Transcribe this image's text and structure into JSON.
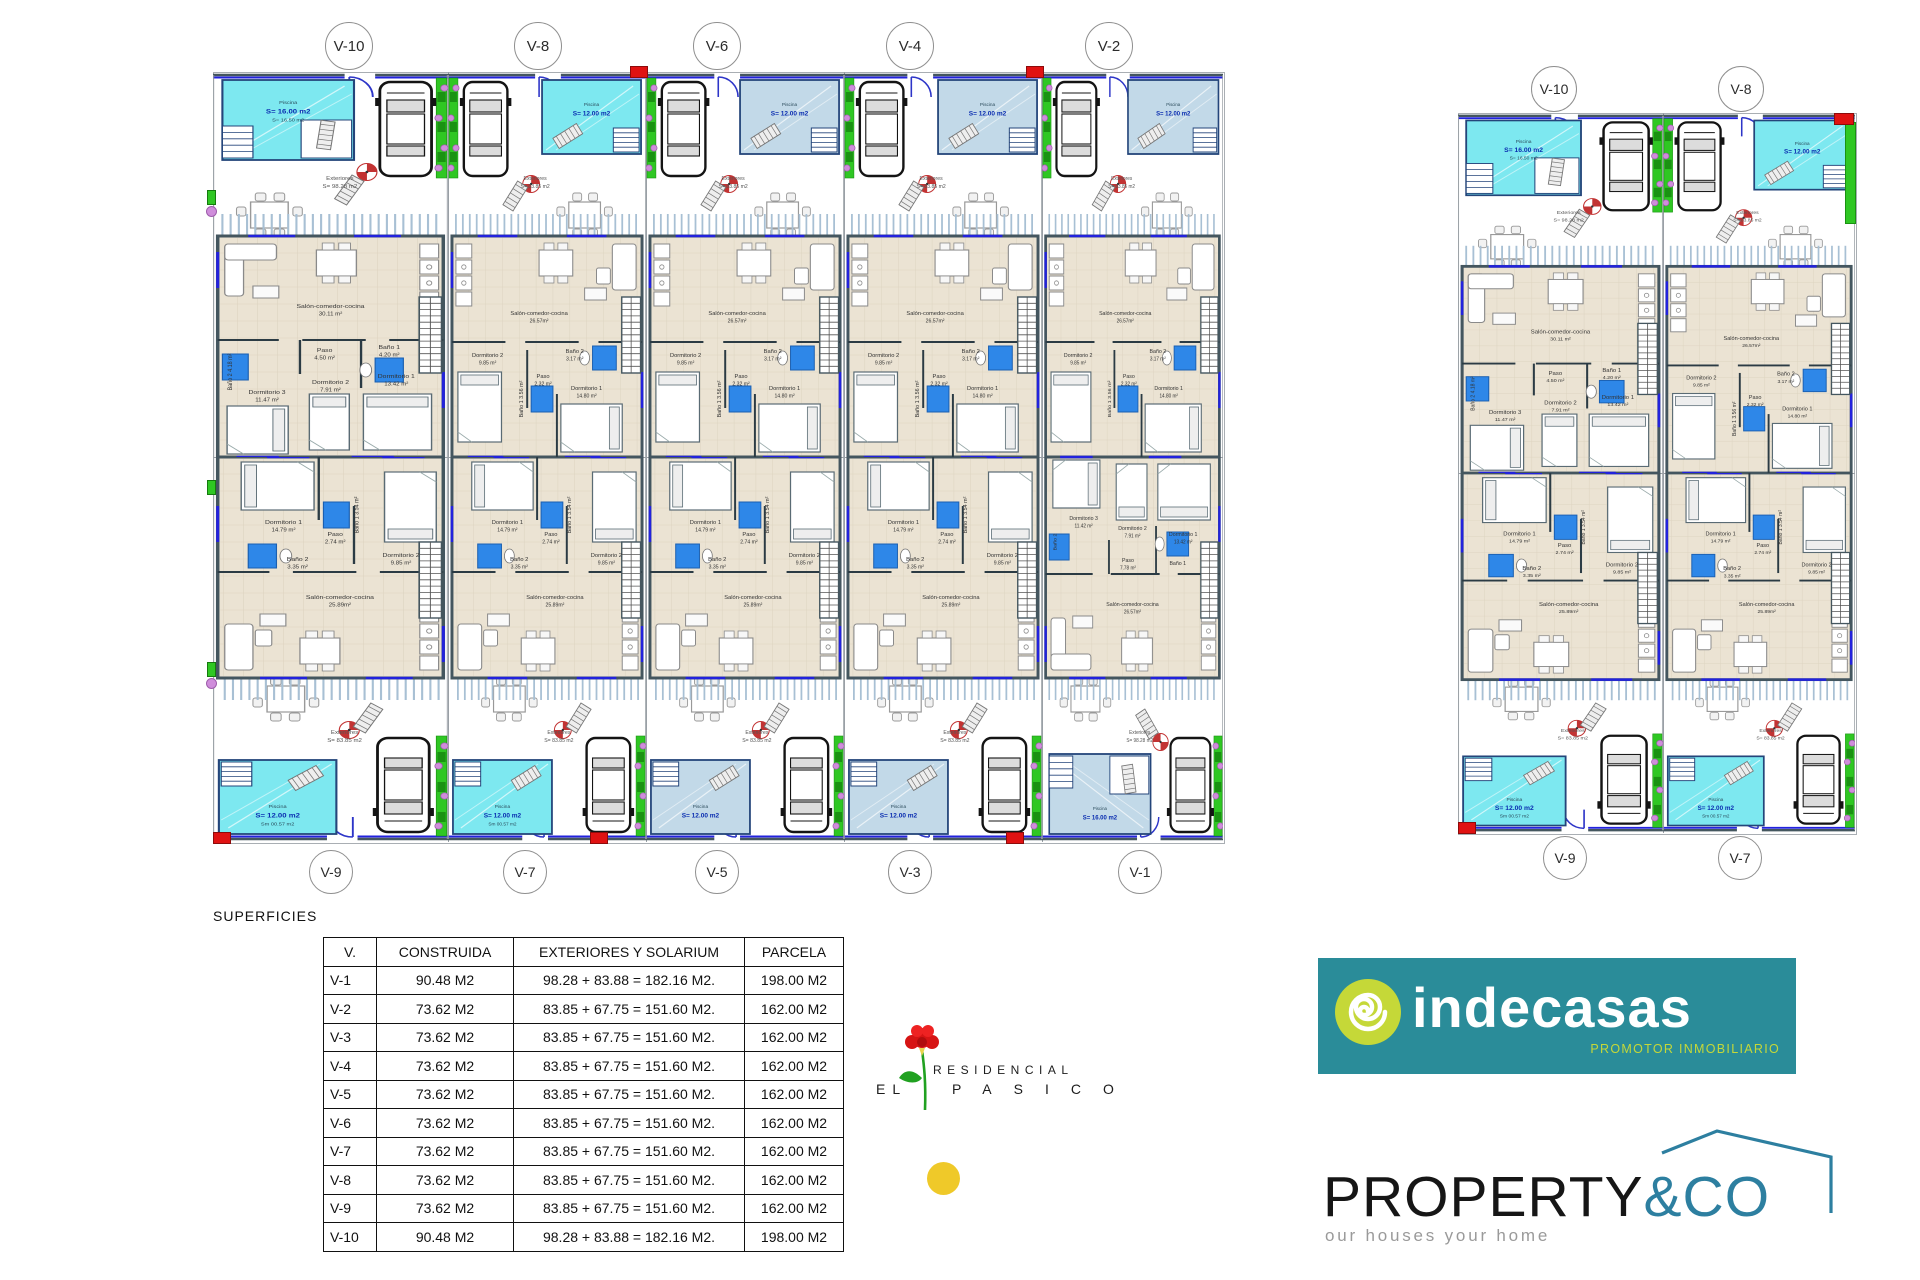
{
  "superficies": {
    "heading": "SUPERFICIES",
    "table": {
      "headers": [
        "V.",
        "CONSTRUIDA",
        "EXTERIORES Y SOLARIUM",
        "PARCELA"
      ],
      "rows": [
        [
          "V-1",
          "90.48 M2",
          "98.28 + 83.88 = 182.16 M2.",
          "198.00 M2"
        ],
        [
          "V-2",
          "73.62 M2",
          "83.85 + 67.75 = 151.60 M2.",
          "162.00 M2"
        ],
        [
          "V-3",
          "73.62 M2",
          "83.85 + 67.75 = 151.60 M2.",
          "162.00 M2"
        ],
        [
          "V-4",
          "73.62 M2",
          "83.85 + 67.75 = 151.60 M2.",
          "162.00 M2"
        ],
        [
          "V-5",
          "73.62 M2",
          "83.85 + 67.75 = 151.60 M2.",
          "162.00 M2"
        ],
        [
          "V-6",
          "73.62 M2",
          "83.85 + 67.75 = 151.60 M2.",
          "162.00 M2"
        ],
        [
          "V-7",
          "73.62 M2",
          "83.85 + 67.75 = 151.60 M2.",
          "162.00 M2"
        ],
        [
          "V-8",
          "73.62 M2",
          "83.85 + 67.75 = 151.60 M2.",
          "162.00 M2"
        ],
        [
          "V-9",
          "73.62 M2",
          "83.85 + 67.75 = 151.60 M2.",
          "162.00 M2"
        ],
        [
          "V-10",
          "90.48 M2",
          "98.28 + 83.88 = 182.16 M2.",
          "198.00 M2"
        ]
      ]
    }
  },
  "branding": {
    "residencial": {
      "line1": "RESIDENCIAL",
      "line2a": "EL",
      "line2b": "PASICO"
    },
    "indecasas": {
      "name": "indecasas",
      "tagline": "PROMOTOR INMOBILIARIO"
    },
    "property": {
      "name": "PROPERTY",
      "suffix": "&CO",
      "tagline": "our houses your home"
    }
  },
  "colors": {
    "pool_cyan": "#7de8f0",
    "pool_pale": "#c2d9e8",
    "pool_stroke": "#24457a",
    "hedge": "#2fc723",
    "hedge_dark": "#1a9212",
    "flower": "#cf8ddb",
    "wall": "#44565f",
    "floor": "#ebe3d3",
    "window_blue": "#2222dd",
    "door_blue": "#2d35c8",
    "fixture_blue": "#2e87e8",
    "marker_red": "#e01212",
    "indecasas_teal": "#2a8c99",
    "indecasas_lime": "#c5d838",
    "property_accent": "#2d7fa0",
    "yellow_dot": "#efc929",
    "carnation_red": "#d61414",
    "stem_green": "#21a121"
  },
  "plan_groups": [
    {
      "id": "left",
      "units": [
        {
          "id": "V-10",
          "row": "top",
          "variant": "corner",
          "pool": {
            "name": "Piscina",
            "area": "S= 16.00 m2",
            "sub": "S= 16.50 m2",
            "color": "cyan"
          },
          "exteriores": {
            "name": "Exteriores",
            "area": "S= 98.28 m2"
          },
          "rooms": {
            "salon": {
              "name": "Salón-comedor-cocina",
              "area": "30.11 m²"
            },
            "paso": {
              "name": "Paso",
              "area": "4.50 m²"
            },
            "bano1": {
              "name": "Baño 1",
              "area": "4.20 m²"
            },
            "bano2": {
              "name": "Baño 2",
              "area": "4.18 m²"
            },
            "dorm1": {
              "name": "Dormitorio 1",
              "area": "13.42 m²"
            },
            "dorm2": {
              "name": "Dormitorio 2",
              "area": "7.91 m²"
            },
            "dorm3": {
              "name": "Dormitorio 3",
              "area": "11.47 m²"
            }
          }
        },
        {
          "id": "V-8",
          "row": "top",
          "variant": "standard",
          "pool": {
            "name": "Piscina",
            "area": "S= 12.00 m2",
            "sub": "",
            "color": "cyan"
          },
          "exteriores": {
            "name": "Exteriores",
            "area": "S= 83.85 m2"
          },
          "rooms": {
            "salon": {
              "name": "Salón-comedor-cocina",
              "area": "26.57m²"
            },
            "paso": {
              "name": "Paso",
              "area": "2.32 m²"
            },
            "bano1": {
              "name": "Baño 1",
              "area": "3.56 m²"
            },
            "bano2": {
              "name": "Baño 2",
              "area": "3.17 m²"
            },
            "dorm1": {
              "name": "Dormitorio 1",
              "area": "14.80 m²"
            },
            "dorm2": {
              "name": "Dormitorio 2",
              "area": "9.85 m²"
            }
          }
        },
        {
          "id": "V-6",
          "row": "top",
          "variant": "standard",
          "pool": {
            "name": "Piscina",
            "area": "S= 12.00 m2",
            "sub": "",
            "color": "pale"
          },
          "exteriores": {
            "name": "Exteriores",
            "area": "S= 83.85 m2"
          },
          "rooms": {
            "salon": {
              "name": "Salón-comedor-cocina",
              "area": "26.57m²"
            },
            "paso": {
              "name": "Paso",
              "area": "2.32 m²"
            },
            "bano1": {
              "name": "Baño 1",
              "area": "3.56 m²"
            },
            "bano2": {
              "name": "Baño 2",
              "area": "3.17 m²"
            },
            "dorm1": {
              "name": "Dormitorio 1",
              "area": "14.80 m²"
            },
            "dorm2": {
              "name": "Dormitorio 2",
              "area": "9.85 m²"
            }
          }
        },
        {
          "id": "V-4",
          "row": "top",
          "variant": "standard",
          "pool": {
            "name": "Piscina",
            "area": "S= 12.00 m2",
            "sub": "",
            "color": "pale"
          },
          "exteriores": {
            "name": "Exteriores",
            "area": "S= 83.85 m2"
          },
          "rooms": {
            "salon": {
              "name": "Salón-comedor-cocina",
              "area": "26.57m²"
            },
            "paso": {
              "name": "Paso",
              "area": "2.32 m²"
            },
            "bano1": {
              "name": "Baño 1",
              "area": "3.56 m²"
            },
            "bano2": {
              "name": "Baño 2",
              "area": "3.17 m²"
            },
            "dorm1": {
              "name": "Dormitorio 1",
              "area": "14.80 m²"
            },
            "dorm2": {
              "name": "Dormitorio 2",
              "area": "9.85 m²"
            }
          }
        },
        {
          "id": "V-2",
          "row": "top",
          "variant": "standard",
          "pool": {
            "name": "Piscina",
            "area": "S= 12.00 m2",
            "sub": "",
            "color": "pale"
          },
          "exteriores": {
            "name": "Exteriores",
            "area": "S= 83.85 m2"
          },
          "rooms": {
            "salon": {
              "name": "Salón-comedor-cocina",
              "area": "26.57m²"
            },
            "paso": {
              "name": "Paso",
              "area": "2.32 m²"
            },
            "bano1": {
              "name": "Baño 1",
              "area": "3.56 m²"
            },
            "bano2": {
              "name": "Baño 2",
              "area": "3.17 m²"
            },
            "dorm1": {
              "name": "Dormitorio 1",
              "area": "14.80 m²"
            },
            "dorm2": {
              "name": "Dormitorio 2",
              "area": "9.85 m²"
            }
          }
        },
        {
          "id": "V-9",
          "row": "bottom",
          "variant": "standard",
          "pool": {
            "name": "Piscina",
            "area": "S= 12.00 m2",
            "sub": "Sm 00.57 m2",
            "color": "cyan"
          },
          "exteriores": {
            "name": "Exteriores",
            "area": "S= 83.85 m2"
          },
          "rooms": {
            "salon": {
              "name": "Salón-comedor-cocina",
              "area": "25.89m²"
            },
            "paso": {
              "name": "Paso",
              "area": "2.74 m²"
            },
            "bano1": {
              "name": "Baño 1",
              "area": "3.54 m²"
            },
            "bano2": {
              "name": "Baño 2",
              "area": "3.35 m²"
            },
            "dorm1": {
              "name": "Dormitorio 1",
              "area": "14.79 m²"
            },
            "dorm2": {
              "name": "Dormitorio 2",
              "area": "9.85 m²"
            }
          }
        },
        {
          "id": "V-7",
          "row": "bottom",
          "variant": "standard",
          "pool": {
            "name": "Piscina",
            "area": "S= 12.00 m2",
            "sub": "Sm 00.57 m2",
            "color": "cyan"
          },
          "exteriores": {
            "name": "Exteriores",
            "area": "S= 83.85 m2"
          },
          "rooms": {
            "salon": {
              "name": "Salón-comedor-cocina",
              "area": "25.89m²"
            },
            "paso": {
              "name": "Paso",
              "area": "2.74 m²"
            },
            "bano1": {
              "name": "Baño 1",
              "area": "3.54 m²"
            },
            "bano2": {
              "name": "Baño 2",
              "area": "3.35 m²"
            },
            "dorm1": {
              "name": "Dormitorio 1",
              "area": "14.79 m²"
            },
            "dorm2": {
              "name": "Dormitorio 2",
              "area": "9.85 m²"
            }
          }
        },
        {
          "id": "V-5",
          "row": "bottom",
          "variant": "standard",
          "pool": {
            "name": "Piscina",
            "area": "S= 12.00 m2",
            "sub": "",
            "color": "pale"
          },
          "exteriores": {
            "name": "Exteriores",
            "area": "S= 83.85 m2"
          },
          "rooms": {
            "salon": {
              "name": "Salón-comedor-cocina",
              "area": "25.89m²"
            },
            "paso": {
              "name": "Paso",
              "area": "2.74 m²"
            },
            "bano1": {
              "name": "Baño 1",
              "area": "3.54 m²"
            },
            "bano2": {
              "name": "Baño 2",
              "area": "3.35 m²"
            },
            "dorm1": {
              "name": "Dormitorio 1",
              "area": "14.79 m²"
            },
            "dorm2": {
              "name": "Dormitorio 2",
              "area": "9.85 m²"
            }
          }
        },
        {
          "id": "V-3",
          "row": "bottom",
          "variant": "standard",
          "pool": {
            "name": "Piscina",
            "area": "S= 12.00 m2",
            "sub": "",
            "color": "pale"
          },
          "exteriores": {
            "name": "Exteriores",
            "area": "S= 83.85 m2"
          },
          "rooms": {
            "salon": {
              "name": "Salón-comedor-cocina",
              "area": "25.89m²"
            },
            "paso": {
              "name": "Paso",
              "area": "2.74 m²"
            },
            "bano1": {
              "name": "Baño 1",
              "area": "3.54 m²"
            },
            "bano2": {
              "name": "Baño 2",
              "area": "3.35 m²"
            },
            "dorm1": {
              "name": "Dormitorio 1",
              "area": "14.79 m²"
            },
            "dorm2": {
              "name": "Dormitorio 2",
              "area": "9.85 m²"
            }
          }
        },
        {
          "id": "V-1",
          "row": "bottom",
          "variant": "corner",
          "pool": {
            "name": "Piscina",
            "area": "S= 16.00 m2",
            "sub": "",
            "color": "pale"
          },
          "exteriores": {
            "name": "Exteriores",
            "area": "S= 98.28 m2"
          },
          "rooms": {
            "salon": {
              "name": "Salón-comedor-cocina",
              "area": "26.57m²"
            },
            "paso": {
              "name": "Paso",
              "area": "7.78 m²"
            },
            "bano1": {
              "name": "Baño 1",
              "area": ""
            },
            "bano2": {
              "name": "Baño 2",
              "area": ""
            },
            "dorm1": {
              "name": "Dormitorio 1",
              "area": "13.42 m²"
            },
            "dorm2": {
              "name": "Dormitorio 2",
              "area": "7.91 m²"
            },
            "dorm3": {
              "name": "Dormitorio 3",
              "area": "11.42 m²"
            }
          }
        }
      ]
    },
    {
      "id": "right",
      "units": [
        {
          "id": "V-10",
          "row": "top",
          "variant": "corner",
          "pool": {
            "name": "Piscina",
            "area": "S= 16.00 m2",
            "sub": "S= 16.50 m2",
            "color": "cyan"
          },
          "exteriores": {
            "name": "Exteriores",
            "area": "S= 98.28 m2"
          },
          "rooms": {
            "salon": {
              "name": "Salón-comedor-cocina",
              "area": "30.11 m²"
            },
            "paso": {
              "name": "Paso",
              "area": "4.50 m²"
            },
            "bano1": {
              "name": "Baño 1",
              "area": "4.20 m²"
            },
            "bano2": {
              "name": "Baño 2",
              "area": "4.18 m²"
            },
            "dorm1": {
              "name": "Dormitorio 1",
              "area": "13.42 m²"
            },
            "dorm2": {
              "name": "Dormitorio 2",
              "area": "7.91 m²"
            },
            "dorm3": {
              "name": "Dormitorio 3",
              "area": "11.47 m²"
            }
          }
        },
        {
          "id": "V-8",
          "row": "top",
          "variant": "standard",
          "pool": {
            "name": "Piscina",
            "area": "S= 12.00 m2",
            "sub": "",
            "color": "cyan"
          },
          "exteriores": {
            "name": "Exteriores",
            "area": "S= 83.85 m2"
          },
          "rooms": {
            "salon": {
              "name": "Salón-comedor-cocina",
              "area": "26.57m²"
            },
            "paso": {
              "name": "Paso",
              "area": "2.32 m²"
            },
            "bano1": {
              "name": "Baño 1",
              "area": "3.56 m²"
            },
            "bano2": {
              "name": "Baño 2",
              "area": "3.17 m²"
            },
            "dorm1": {
              "name": "Dormitorio 1",
              "area": "14.80 m²"
            },
            "dorm2": {
              "name": "Dormitorio 2",
              "area": "9.85 m²"
            }
          }
        },
        {
          "id": "V-9",
          "row": "bottom",
          "variant": "standard",
          "pool": {
            "name": "Piscina",
            "area": "S= 12.00 m2",
            "sub": "Sm 00.57 m2",
            "color": "cyan"
          },
          "exteriores": {
            "name": "Exteriores",
            "area": "S= 83.85 m2"
          },
          "rooms": {
            "salon": {
              "name": "Salón-comedor-cocina",
              "area": "25.89m²"
            },
            "paso": {
              "name": "Paso",
              "area": "2.74 m²"
            },
            "bano1": {
              "name": "Baño 1",
              "area": "3.54 m²"
            },
            "bano2": {
              "name": "Baño 2",
              "area": "3.35 m²"
            },
            "dorm1": {
              "name": "Dormitorio 1",
              "area": "14.79 m²"
            },
            "dorm2": {
              "name": "Dormitorio 2",
              "area": "9.85 m²"
            }
          }
        },
        {
          "id": "V-7",
          "row": "bottom",
          "variant": "standard",
          "pool": {
            "name": "Piscina",
            "area": "S= 12.00 m2",
            "sub": "Sm 00.57 m2",
            "color": "cyan"
          },
          "exteriores": {
            "name": "Exteriores",
            "area": "S= 83.85 m2"
          },
          "rooms": {
            "salon": {
              "name": "Salón-comedor-cocina",
              "area": "25.89m²"
            },
            "paso": {
              "name": "Paso",
              "area": "2.74 m²"
            },
            "bano1": {
              "name": "Baño 1",
              "area": "3.54 m²"
            },
            "bano2": {
              "name": "Baño 2",
              "area": "3.35 m²"
            },
            "dorm1": {
              "name": "Dormitorio 1",
              "area": "14.79 m²"
            },
            "dorm2": {
              "name": "Dormitorio 2",
              "area": "9.85 m²"
            }
          }
        }
      ]
    }
  ]
}
